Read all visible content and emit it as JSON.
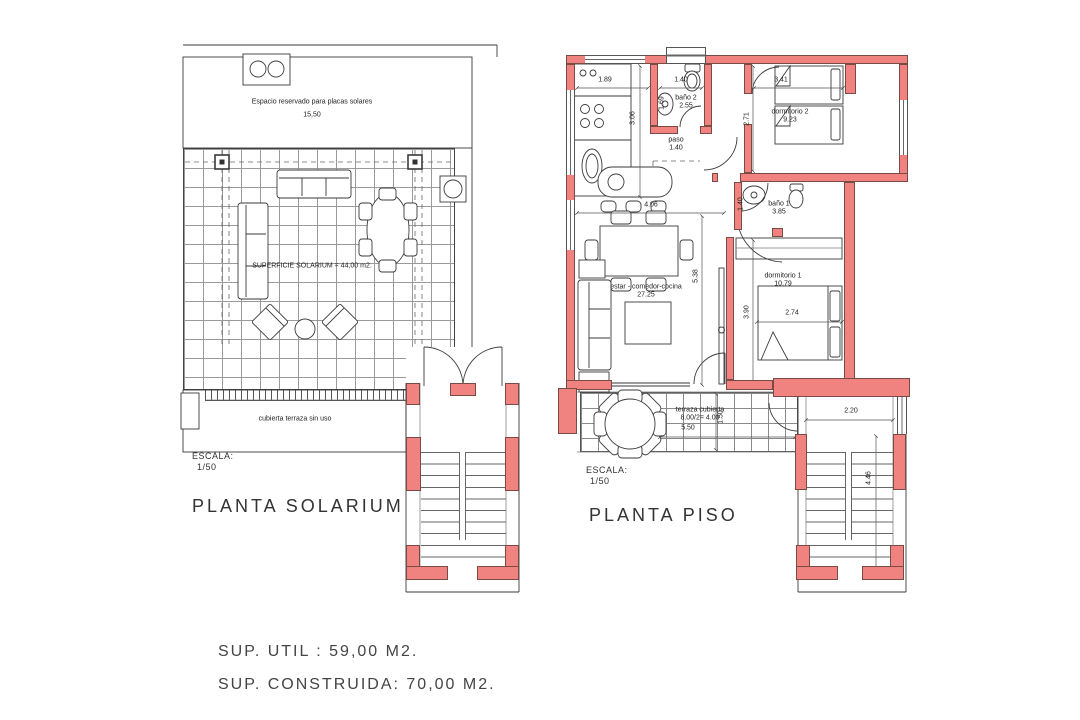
{
  "document": {
    "type": "architectural floor plan",
    "footer": {
      "sup_util": "SUP. UTIL : 59,00 M2.",
      "sup_construida": "SUP. CONSTRUIDA: 70,00 M2."
    }
  },
  "colors": {
    "wall_fill": "#F0837F",
    "wall_stroke": "#7A4A45",
    "line": "#3A3A3A"
  },
  "solarium": {
    "title": "PLANTA SOLARIUM",
    "scale_label": "ESCALA:",
    "scale_value": "1/50",
    "solar_note": "Espacio reservado para placas solares",
    "solar_note_dim": "15,50",
    "surface_label": "SUPERFICIE SOLARIUM = 44,00 m2.",
    "terrace_note": "cubierta terraza sin uso"
  },
  "piso": {
    "title": "PLANTA PISO",
    "scale_label": "ESCALA:",
    "scale_value": "1/50",
    "rooms": {
      "bano2": {
        "name": "baño 2",
        "area": "2.55"
      },
      "paso": {
        "name": "paso",
        "area": "1.40"
      },
      "dormitorio2": {
        "name": "dormitorio 2",
        "area": "9.23"
      },
      "bano1": {
        "name": "baño 1",
        "area": "3.85"
      },
      "estar": {
        "name": "estar - comedor-cocina",
        "area": "27.25"
      },
      "dormitorio1": {
        "name": "dormitorio 1",
        "area": "10.79"
      },
      "terraza": {
        "name": "terraza cubierta",
        "area": "8.00/2= 4.00"
      }
    },
    "dims": {
      "cocina_ancho": "1.89",
      "cocina_alto": "3.06",
      "bano2_ancho": "1.40",
      "bano2_alto": "1.69",
      "dorm2_ancho": "3.41",
      "dorm2_alto": "2.71",
      "estar_ancho": "4.06",
      "estar_alto": "5.38",
      "bano1_alto": "1.40",
      "dorm1_alto": "3.90",
      "cama_ancho": "2.74",
      "terraza_ancho": "5.50",
      "terraza_alto": "1.50",
      "escalera_ancho": "2.20",
      "escalera_alto": "4.46"
    }
  }
}
